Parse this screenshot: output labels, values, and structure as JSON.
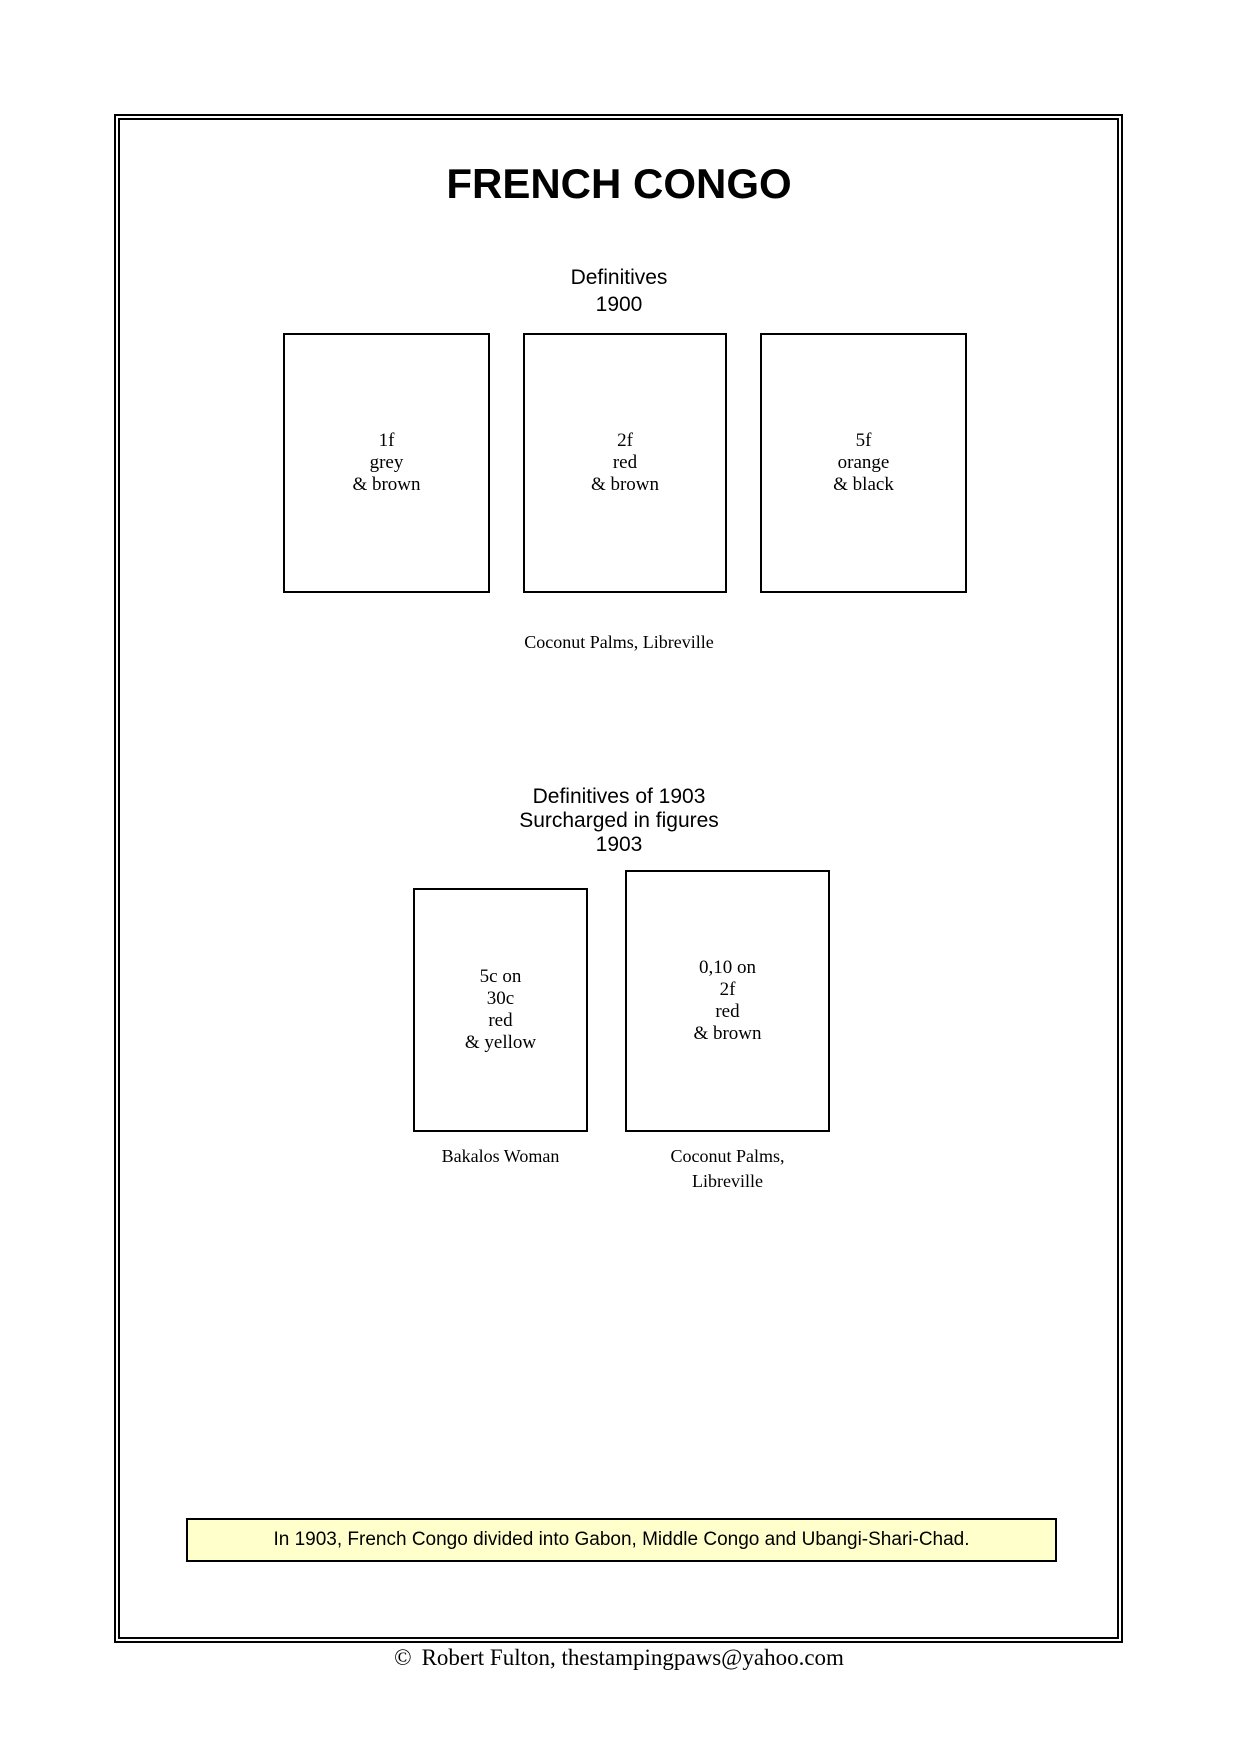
{
  "page": {
    "title": "FRENCH CONGO",
    "note": {
      "text": "In 1903, French Congo divided into Gabon, Middle Congo and Ubangi-Shari-Chad.",
      "bg_color": "#FFFFCC"
    },
    "footer": {
      "copyright_symbol": "©",
      "text": "Robert Fulton, thestampingpaws@yahoo.com"
    }
  },
  "sections": [
    {
      "heading_lines": [
        "Definitives",
        "1900"
      ],
      "stamps": [
        {
          "lines": [
            "1f",
            "grey",
            "& brown"
          ]
        },
        {
          "lines": [
            "2f",
            "red",
            "& brown"
          ]
        },
        {
          "lines": [
            "5f",
            "orange",
            "& black"
          ]
        }
      ],
      "caption": "Coconut Palms, Libreville"
    },
    {
      "heading_lines": [
        "Definitives of 1903",
        "Surcharged in figures",
        "1903"
      ],
      "stamps": [
        {
          "lines": [
            "5c on",
            "30c",
            "red",
            "& yellow"
          ],
          "caption_lines": [
            "Bakalos Woman"
          ]
        },
        {
          "lines": [
            "0,10 on",
            "2f",
            "red",
            "& brown"
          ],
          "caption_lines": [
            "Coconut Palms,",
            "Libreville"
          ]
        }
      ]
    }
  ]
}
